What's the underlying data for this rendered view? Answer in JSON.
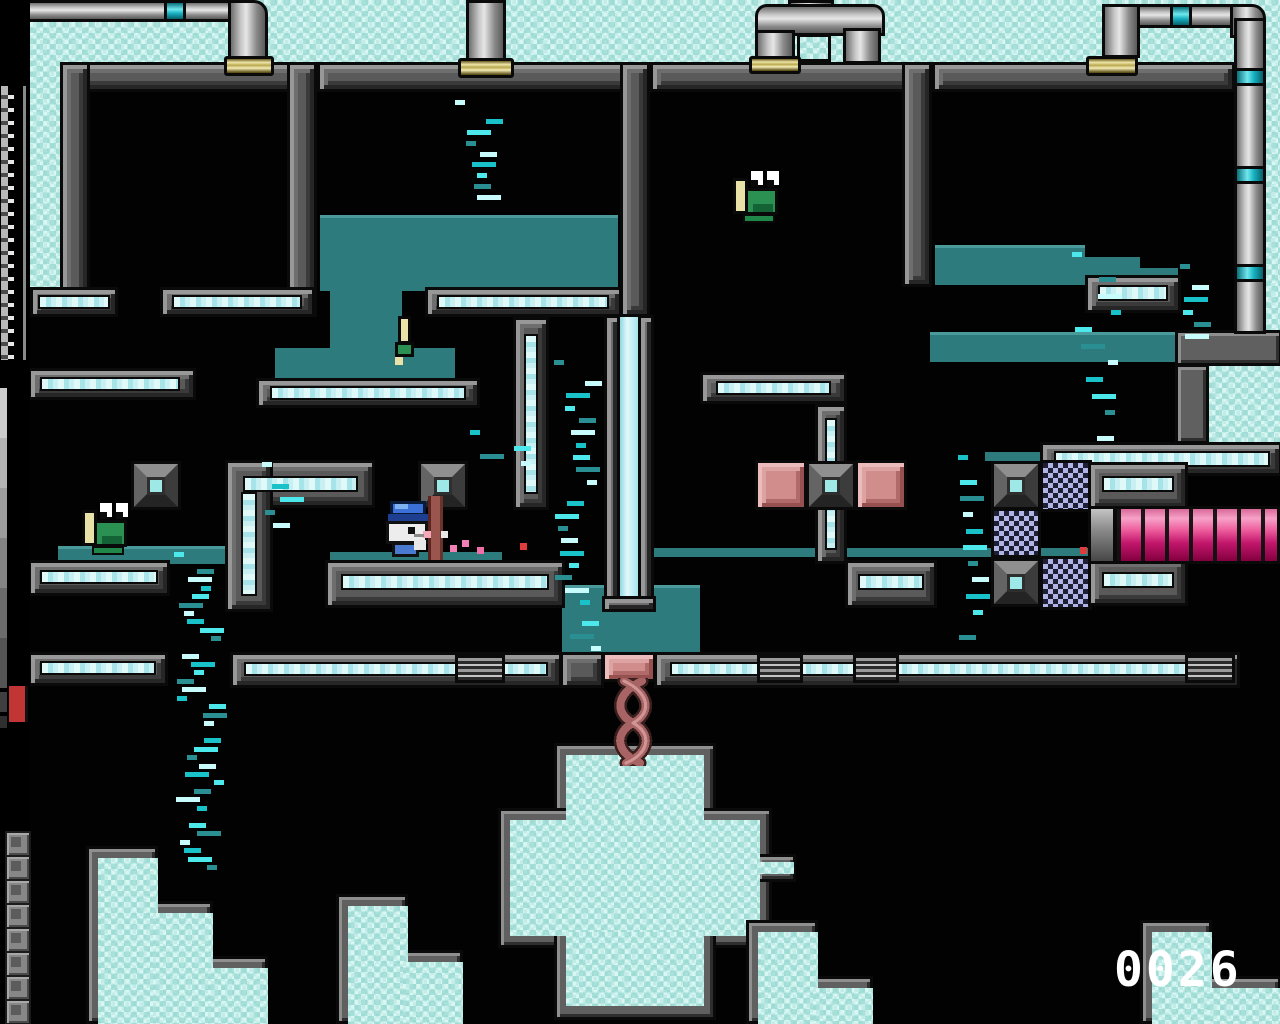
{
  "score": {
    "value": "0026",
    "color": "#ffffff"
  },
  "hud": {
    "gauge": {
      "description": "vertical level gauge with tick marks",
      "tick_color": "#e8e8e8"
    },
    "gradient_steps": [
      "#cccccc",
      "#b4b4b4",
      "#9c9c9c",
      "#848484",
      "#6c6c6c",
      "#545454"
    ],
    "alert_color": "#c23535",
    "slot_count": 8
  },
  "palette": {
    "background": "#c2ece7",
    "wall": "#5a5a5a",
    "chamber": "#020202",
    "water": "#2e7b7d",
    "crystal_stripe": "#c8f0f2",
    "pipe_band": "#17b0c0",
    "coupling_gold": "#e9df9a",
    "push_block_pink": "#d18c8c",
    "tube_magenta": "#c2176c",
    "checker_light": "#b0b4e4",
    "checker_dark": "#1e1e34",
    "rope": "#a86464"
  },
  "entities": [
    {
      "id": "creature-top",
      "label": "green creature in upper chamber",
      "x": 731,
      "y": 166
    },
    {
      "id": "creature-left",
      "label": "green creature on left ledge",
      "x": 80,
      "y": 498
    },
    {
      "id": "creature-swim",
      "label": "green creature in waterfall",
      "x": 391,
      "y": 314
    },
    {
      "id": "player-mouse",
      "label": "white mouse with blue cap",
      "x": 378,
      "y": 501
    }
  ],
  "effects": {
    "colors": [
      "#4de8ec",
      "#2a8f92",
      "#c8fbfc",
      "#18c2c8"
    ],
    "bands": [
      {
        "x": 174,
        "y": 552,
        "w": 54,
        "h": 326,
        "n": 34
      },
      {
        "x": 554,
        "y": 360,
        "w": 50,
        "h": 300,
        "n": 22
      },
      {
        "x": 455,
        "y": 100,
        "w": 50,
        "h": 112,
        "n": 9
      },
      {
        "x": 958,
        "y": 455,
        "w": 36,
        "h": 196,
        "n": 11
      },
      {
        "x": 1072,
        "y": 252,
        "w": 52,
        "h": 200,
        "n": 11
      },
      {
        "x": 1180,
        "y": 264,
        "w": 34,
        "h": 86,
        "n": 6
      },
      {
        "x": 262,
        "y": 462,
        "w": 46,
        "h": 76,
        "n": 5
      },
      {
        "x": 470,
        "y": 430,
        "w": 70,
        "h": 40,
        "n": 4
      }
    ],
    "sparks": [
      {
        "x": 441,
        "y": 531,
        "c": "#e8e8e8"
      },
      {
        "x": 450,
        "y": 545,
        "c": "#f27fb4"
      },
      {
        "x": 462,
        "y": 540,
        "c": "#f27fb4"
      },
      {
        "x": 477,
        "y": 547,
        "c": "#f06fa8"
      },
      {
        "x": 520,
        "y": 543,
        "c": "#e03c3c"
      },
      {
        "x": 1080,
        "y": 547,
        "c": "#e03c3c"
      }
    ]
  }
}
